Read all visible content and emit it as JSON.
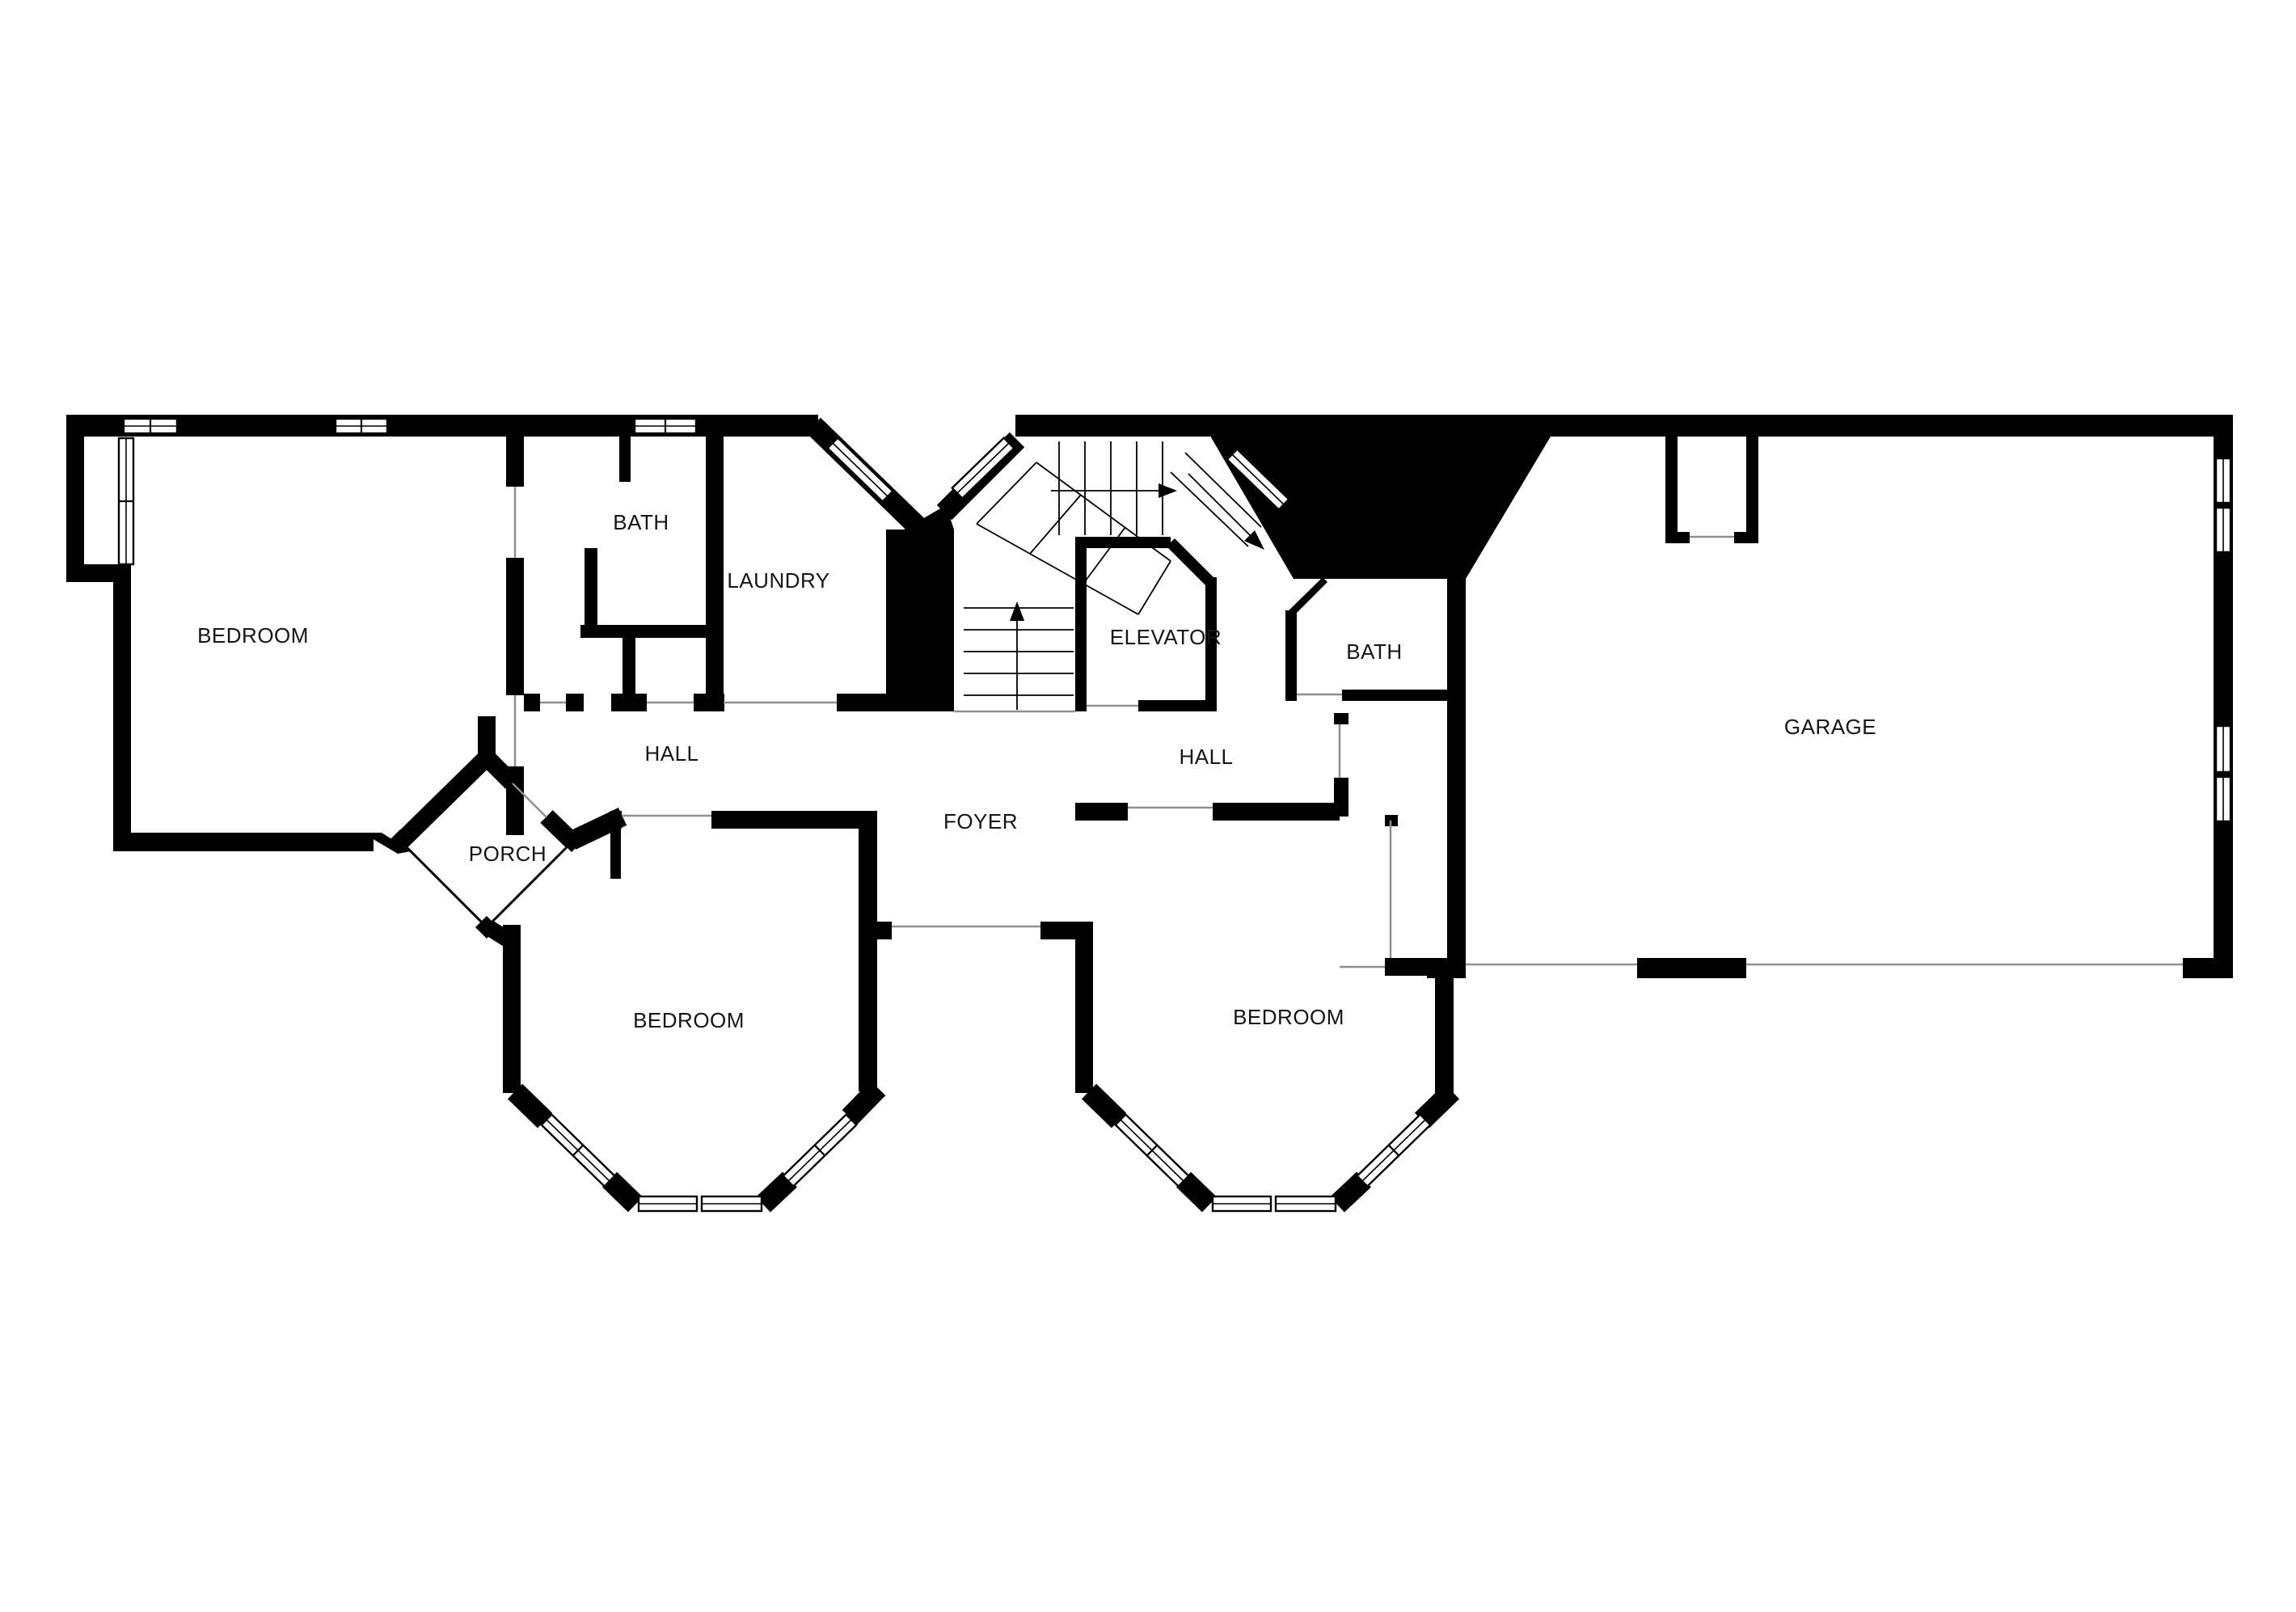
{
  "floor_plan": {
    "title": "Floor plan",
    "colors": {
      "wall": "#000000",
      "floor": "#ffffff",
      "door_line": "#8f8f8f",
      "stair_line": "#000000",
      "label_text": "#151515"
    },
    "rooms": [
      {
        "id": "bedroom-top-left",
        "label": "BEDROOM"
      },
      {
        "id": "bath-top-left",
        "label": "BATH"
      },
      {
        "id": "laundry",
        "label": "LAUNDRY"
      },
      {
        "id": "elevator",
        "label": "ELEVATOR"
      },
      {
        "id": "bath-center-right",
        "label": "BATH"
      },
      {
        "id": "hall-left",
        "label": "HALL"
      },
      {
        "id": "hall-right",
        "label": "HALL"
      },
      {
        "id": "foyer",
        "label": "FOYER"
      },
      {
        "id": "porch",
        "label": "PORCH"
      },
      {
        "id": "bedroom-bottom-left",
        "label": "BEDROOM"
      },
      {
        "id": "bedroom-bottom-right",
        "label": "BEDROOM"
      },
      {
        "id": "garage",
        "label": "GARAGE"
      }
    ],
    "stairs": {
      "arrows": [
        "up",
        "right",
        "down-right"
      ],
      "runs": 4
    },
    "features": {
      "bay_windows": 2,
      "garage_door_openings": 2,
      "diagonal_windows": 3
    }
  }
}
